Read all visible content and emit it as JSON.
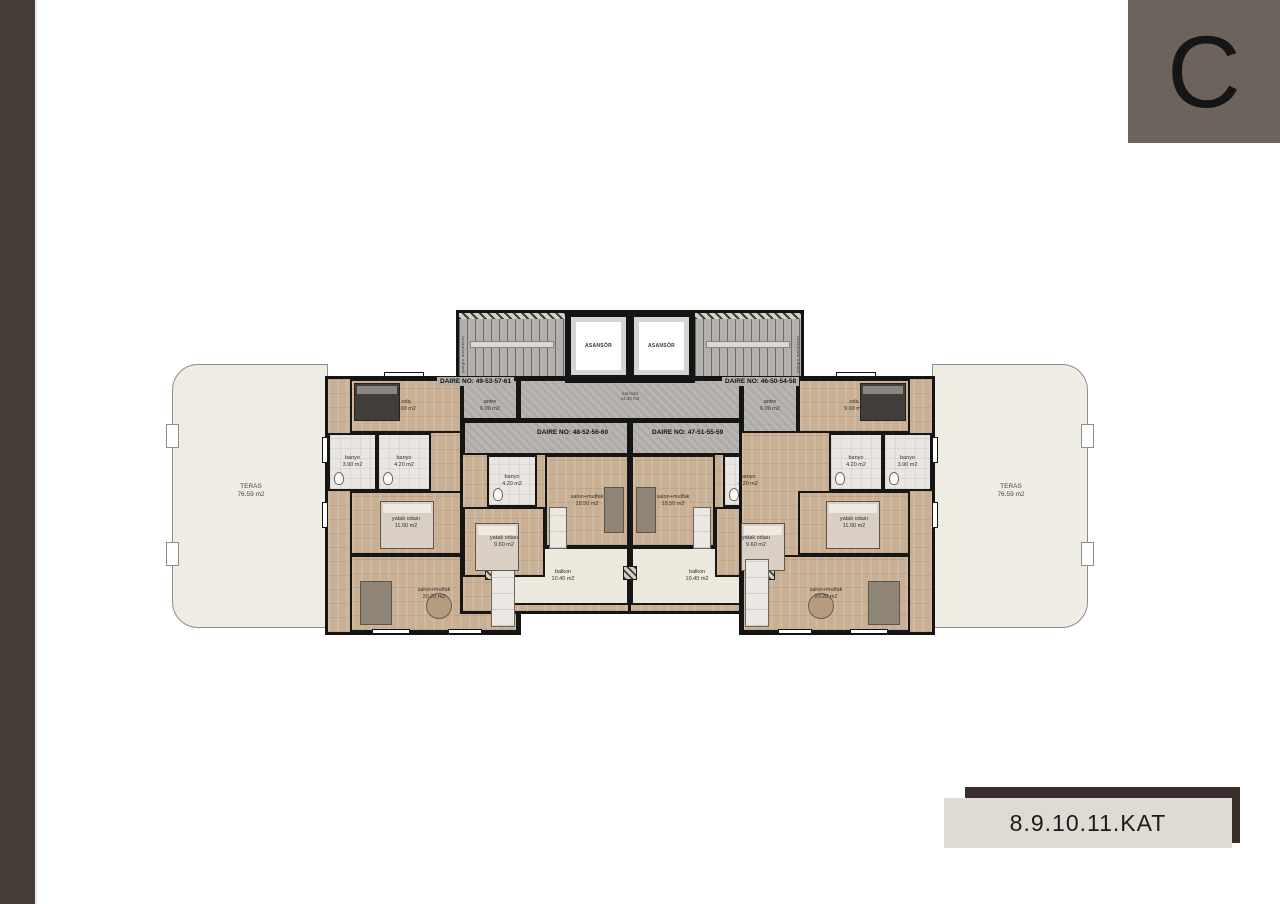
{
  "window": {
    "block_letter": "C",
    "floor_label": "8.9.10.11.KAT"
  },
  "palette": {
    "sidebar": "#463D39",
    "letter_tile": "#6B635C",
    "badge_shadow": "#382E2A",
    "badge_face": "#DDDBD2",
    "walls": "#141414",
    "wood_floor": "#C9AF94",
    "corridor_gray": "#B5B2AD",
    "terrace_cream": "#EFECE3"
  },
  "plan": {
    "terrace_left": {
      "name": "TERAS",
      "area": "76.59 m2"
    },
    "terrace_right": {
      "name": "TERAS",
      "area": "76.59 m2"
    },
    "core": {
      "stair_left_label": "yangın merdiveni",
      "stair_right_label": "yangın merdiveni",
      "elevator_left": "ASANSÖR",
      "elevator_right": "ASANSÖR",
      "hall_name": "kat holü",
      "hall_area": "14.30 m2"
    },
    "apartments": {
      "outer_left": {
        "daire_no": "DAIRE NO: 49-53-57-61",
        "rooms": {
          "bedroom": {
            "name": "oda",
            "area": "9.00 m2"
          },
          "antre": {
            "name": "antre",
            "area": "6.00 m2"
          },
          "bath1": {
            "name": "banyo",
            "area": "3.90 m2"
          },
          "bath2": {
            "name": "banyo",
            "area": "4.20 m2"
          },
          "master": {
            "name": "yatak odası",
            "area": "11.00 m2"
          },
          "living": {
            "name": "salon+mutfak",
            "area": "20.20 m2"
          }
        }
      },
      "inner_left": {
        "daire_no": "DAIRE NO: 48-52-56-60",
        "rooms": {
          "bath": {
            "name": "banyo",
            "area": "4.20 m2"
          },
          "bedroom": {
            "name": "yatak odası",
            "area": "9.60 m2"
          },
          "living": {
            "name": "salon+mutfak",
            "area": "19.50 m2"
          },
          "balcony": {
            "name": "balkon",
            "area": "10.40 m2"
          }
        }
      },
      "inner_right": {
        "daire_no": "DAIRE NO: 47-51-55-59",
        "rooms": {
          "bath": {
            "name": "banyo",
            "area": "4.20 m2"
          },
          "bedroom": {
            "name": "yatak odası",
            "area": "9.60 m2"
          },
          "living": {
            "name": "salon+mutfak",
            "area": "19.50 m2"
          },
          "balcony": {
            "name": "balkon",
            "area": "10.40 m2"
          }
        }
      },
      "outer_right": {
        "daire_no": "DAIRE NO: 46-50-54-58",
        "rooms": {
          "bedroom": {
            "name": "oda",
            "area": "9.00 m2"
          },
          "antre": {
            "name": "antre",
            "area": "6.00 m2"
          },
          "bath1": {
            "name": "banyo",
            "area": "3.90 m2"
          },
          "bath2": {
            "name": "banyo",
            "area": "4.20 m2"
          },
          "master": {
            "name": "yatak odası",
            "area": "11.00 m2"
          },
          "living": {
            "name": "salon+mutfak",
            "area": "20.20 m2"
          }
        }
      }
    }
  }
}
